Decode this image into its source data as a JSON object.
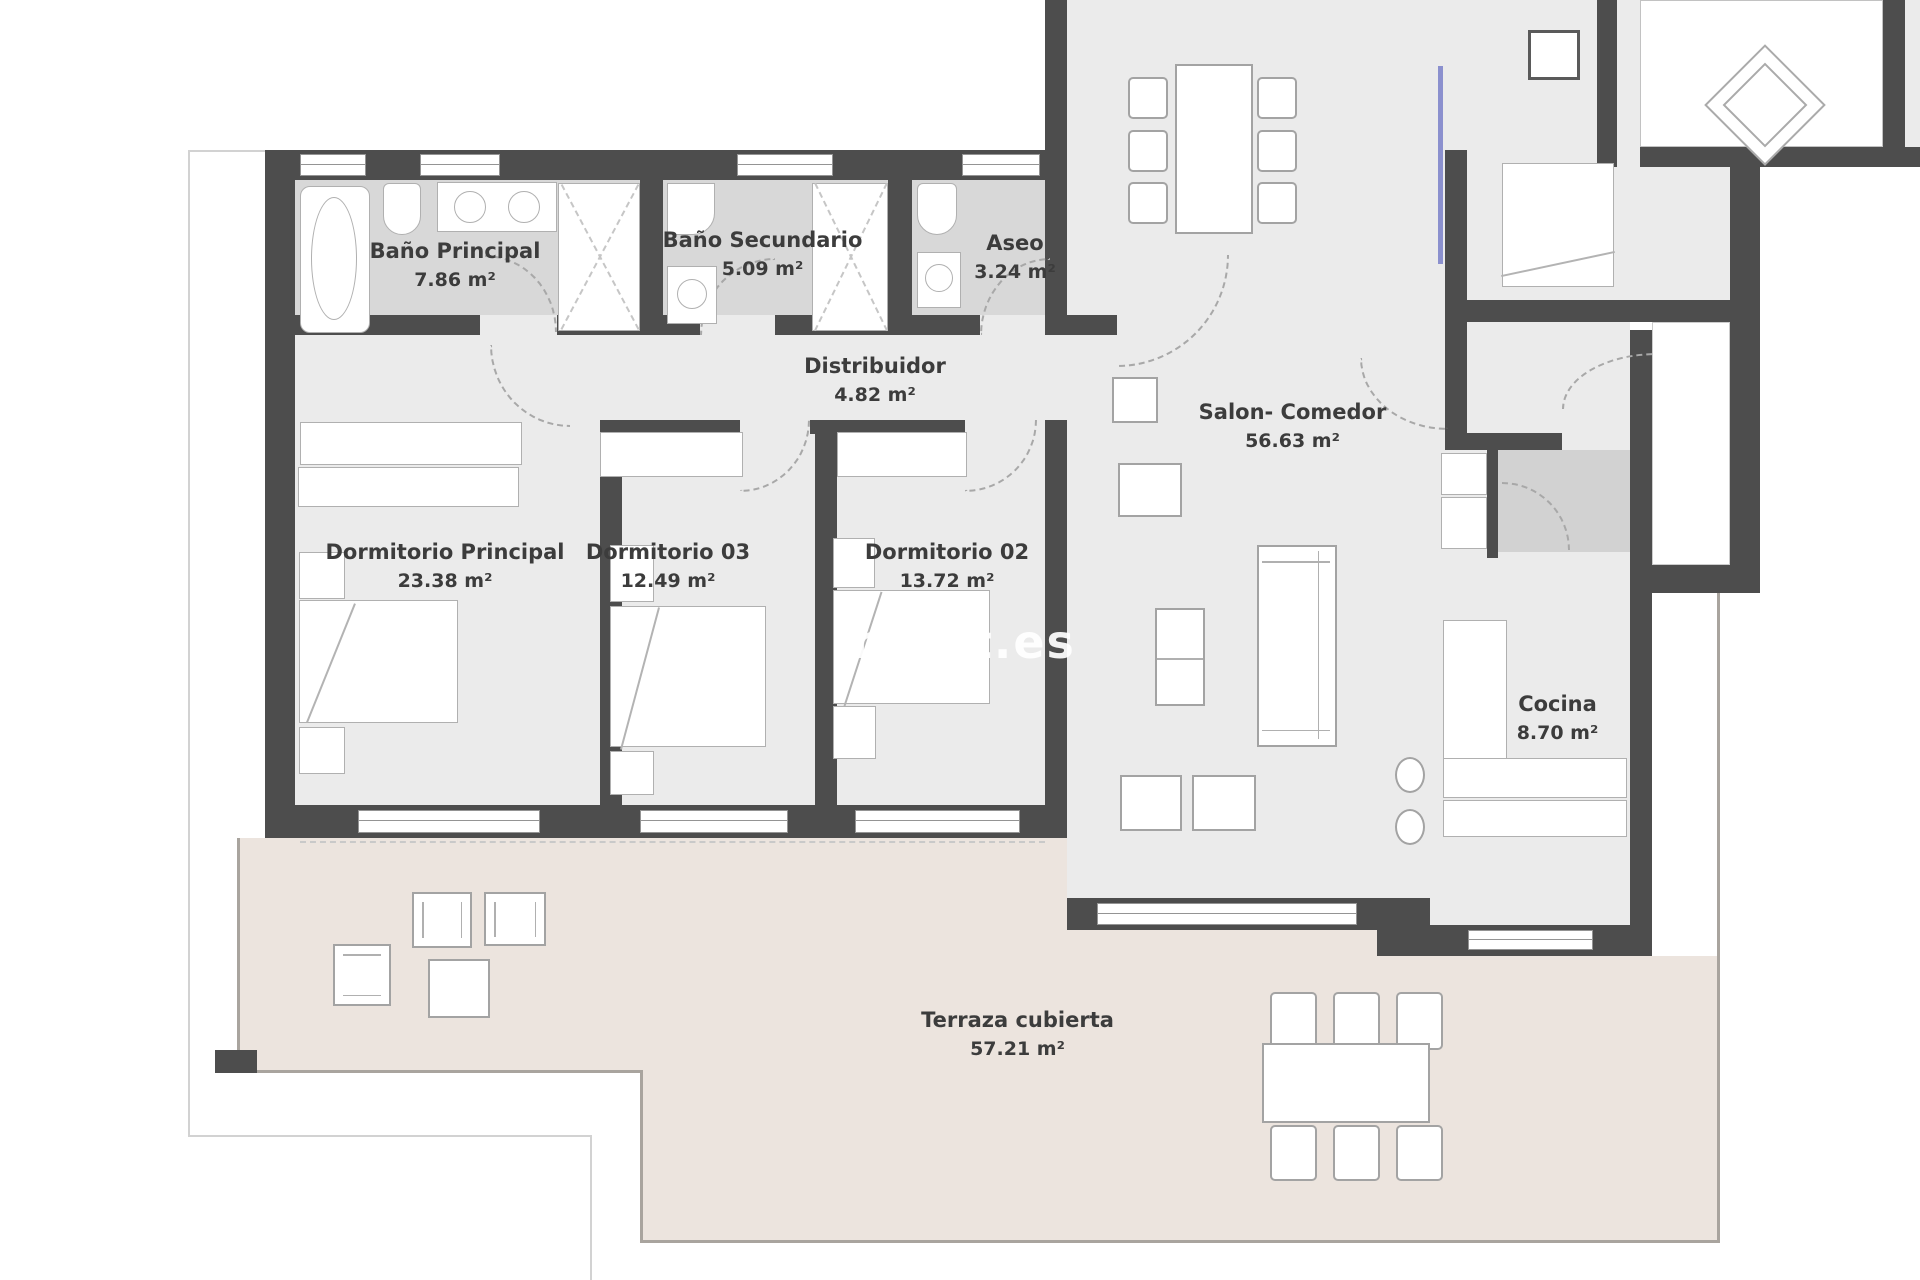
{
  "plan": {
    "watermark": "ment.es",
    "rooms": [
      {
        "id": "bano_principal",
        "name": "Baño Principal",
        "area": "7.86 m²"
      },
      {
        "id": "bano_secundario",
        "name": "Baño Secundario",
        "area": "5.09 m²"
      },
      {
        "id": "aseo",
        "name": "Aseo",
        "area": "3.24 m²"
      },
      {
        "id": "distribuidor",
        "name": "Distribuidor",
        "area": "4.82 m²"
      },
      {
        "id": "salon_comedor",
        "name": "Salon- Comedor",
        "area": "56.63 m²"
      },
      {
        "id": "dormitorio_principal",
        "name": "Dormitorio Principal",
        "area": "23.38 m²"
      },
      {
        "id": "dormitorio_03",
        "name": "Dormitorio 03",
        "area": "12.49 m²"
      },
      {
        "id": "dormitorio_02",
        "name": "Dormitorio 02",
        "area": "13.72 m²"
      },
      {
        "id": "cocina",
        "name": "Cocina",
        "area": "8.70 m²"
      },
      {
        "id": "terraza_cubierta",
        "name": "Terraza cubierta",
        "area": "57.21 m²"
      }
    ],
    "colors": {
      "wall": "#4d4d4d",
      "floor": "#ebebeb",
      "bathroom_floor": "#d8d8d8",
      "terrace_floor": "#ece4de",
      "accent_line": "#8b90ce"
    }
  }
}
